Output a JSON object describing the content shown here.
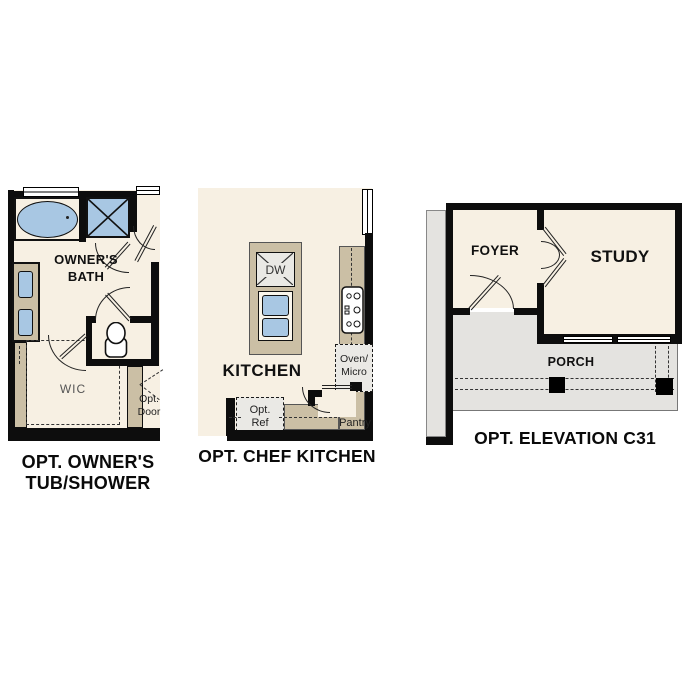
{
  "colors": {
    "floor": "#f7f0e3",
    "tan": "#cbbfa5",
    "blue": "#a8c7e3",
    "porch": "#e4e3e0",
    "appliance": "#eae9e5",
    "wall": "#0d0d0d",
    "line": "#222222"
  },
  "panels": {
    "tub_shower": {
      "caption_line1": "OPT. OWNER'S",
      "caption_line2": "TUB/SHOWER",
      "room_line1": "OWNER'S",
      "room_line2": "BATH",
      "wic": "WIC",
      "opt_door_line1": "Opt.",
      "opt_door_line2": "Door"
    },
    "chef_kitchen": {
      "caption": "OPT. CHEF KITCHEN",
      "room": "KITCHEN",
      "dw": "DW",
      "oven_line1": "Oven/",
      "oven_line2": "Micro",
      "ref_line1": "Opt.",
      "ref_line2": "Ref",
      "pantry": "Pantry"
    },
    "elevation": {
      "caption": "OPT. ELEVATION C31",
      "foyer": "FOYER",
      "study": "STUDY",
      "porch": "PORCH"
    }
  }
}
